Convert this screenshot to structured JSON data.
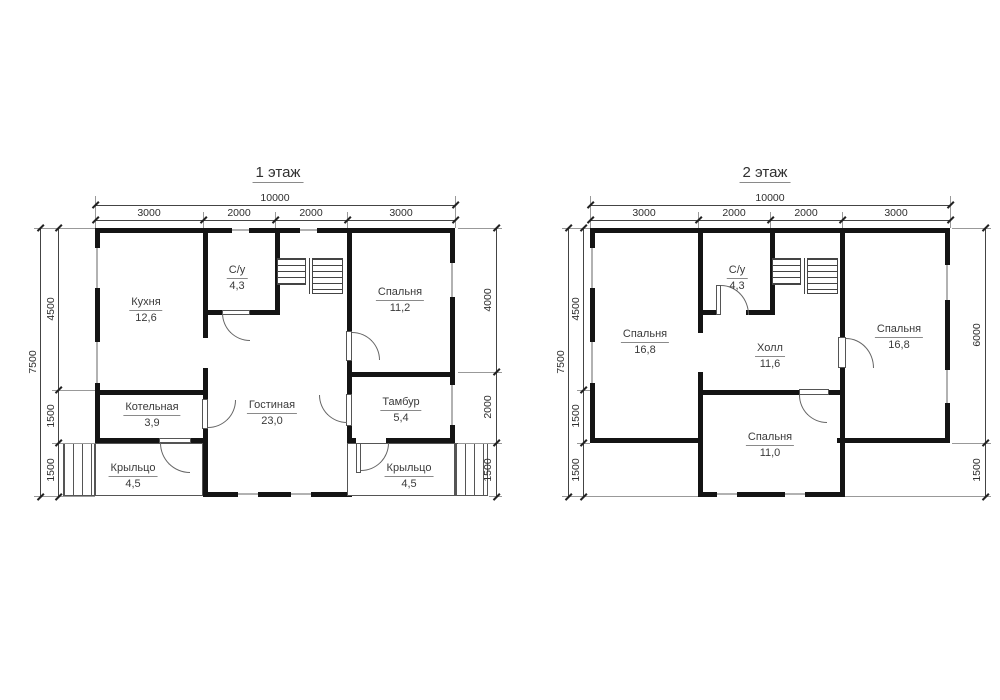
{
  "colors": {
    "wall": "#141414",
    "line": "#555555",
    "text": "#3a3a3a"
  },
  "plan1": {
    "title": "1 этаж",
    "dims": {
      "top_total": "10000",
      "top_segments": [
        "3000",
        "2000",
        "2000",
        "3000"
      ],
      "left_total": "7500",
      "left_segments": [
        "4500",
        "1500",
        "1500"
      ],
      "right_segments": [
        "4000",
        "2000",
        "1500"
      ]
    },
    "rooms": [
      {
        "name": "Кухня",
        "area": "12,6"
      },
      {
        "name": "С/у",
        "area": "4,3"
      },
      {
        "name": "Спальня",
        "area": "11,2"
      },
      {
        "name": "Котельная",
        "area": "3,9"
      },
      {
        "name": "Гостиная",
        "area": "23,0"
      },
      {
        "name": "Тамбур",
        "area": "5,4"
      },
      {
        "name": "Крыльцо",
        "area": "4,5"
      },
      {
        "name": "Крыльцо",
        "area": "4,5"
      }
    ]
  },
  "plan2": {
    "title": "2 этаж",
    "dims": {
      "top_total": "10000",
      "top_segments": [
        "3000",
        "2000",
        "2000",
        "3000"
      ],
      "left_total": "7500",
      "left_segments": [
        "4500",
        "1500",
        "1500"
      ],
      "right_segments": [
        "6000",
        "1500"
      ]
    },
    "rooms": [
      {
        "name": "Спальня",
        "area": "16,8"
      },
      {
        "name": "С/у",
        "area": "4,3"
      },
      {
        "name": "Холл",
        "area": "11,6"
      },
      {
        "name": "Спальня",
        "area": "16,8"
      },
      {
        "name": "Спальня",
        "area": "11,0"
      }
    ]
  }
}
